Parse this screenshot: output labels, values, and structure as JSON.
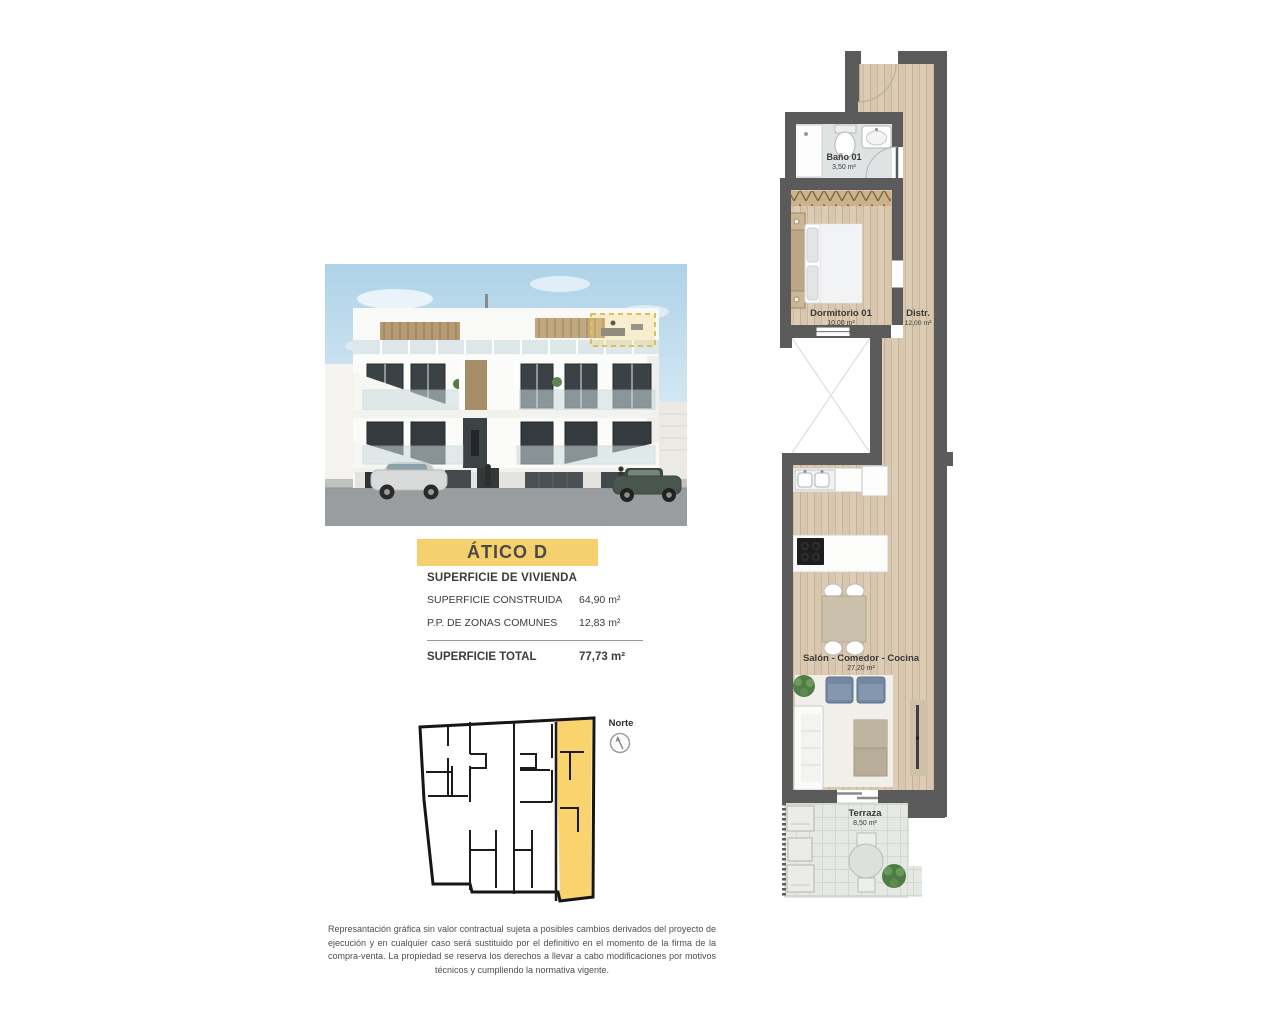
{
  "page": {
    "background": "#ffffff"
  },
  "hero_render": {
    "description": "building-facade-render",
    "highlight_color": "#f6d26e"
  },
  "title_banner": {
    "label": "ÁTICO D",
    "background": "#f5d06e",
    "text_color": "#4b4b45"
  },
  "surface_table": {
    "header": "SUPERFICIE DE VIVIENDA",
    "rows": [
      {
        "label": "SUPERFICIE CONSTRUIDA",
        "value": "64,90 m²"
      },
      {
        "label": "P.P. DE ZONAS COMUNES",
        "value": "12,83 m²"
      }
    ],
    "total": {
      "label": "SUPERFICIE TOTAL",
      "value": "77,73 m²"
    }
  },
  "locator": {
    "north_label": "Norte",
    "highlight_color": "#f8d36e"
  },
  "floorplan": {
    "wall_color": "#5b5b5b",
    "wood_color": "#d8c6ae",
    "rooms": [
      {
        "name": "Baño 01",
        "area": "3,50 m²"
      },
      {
        "name": "Dormitorio 01",
        "area": "10,00 m²"
      },
      {
        "name": "Distr.",
        "area": "12,00 m²"
      },
      {
        "name": "Salón - Comedor - Cocina",
        "area": "27,20 m²"
      },
      {
        "name": "Terraza",
        "area": "8,50 m²"
      }
    ]
  },
  "disclaimer": "Represantación gráfica sin valor contractual sujeta a posibles cambios derivados del proyecto de ejecución y en cualquier caso será sustituido por el definitivo en el momento de la firma de la compra-venta. La propiedad se reserva los derechos a llevar a cabo modificaciones por motivos técnicos y cumpliendo la normativa vigente."
}
